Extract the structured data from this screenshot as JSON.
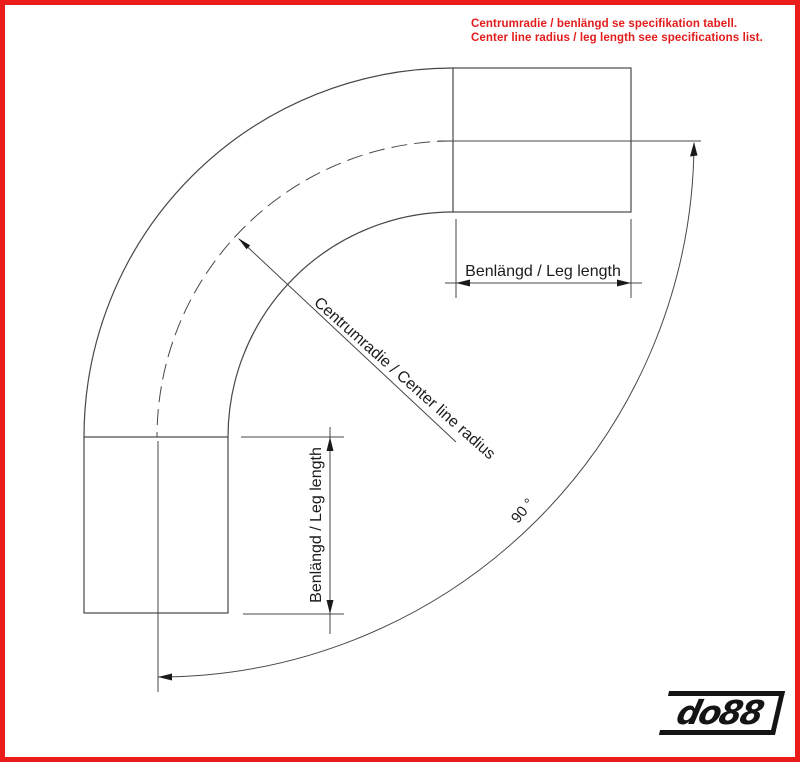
{
  "header": {
    "note_sv": "Centrumradie / benlängd se specifikation tabell.",
    "note_en": "Center line radius / leg length see specifications list."
  },
  "diagram": {
    "type": "technical-drawing",
    "subject": "90 degree pipe elbow with dimension callouts",
    "labels": {
      "top_leg": "Benlängd / Leg length",
      "left_leg": "Benlängd / Leg length",
      "radius": "Centrumradie / Center line radius",
      "angle": "90 °"
    }
  },
  "branding": {
    "logo_text": "do88"
  },
  "colors": {
    "frame_red": "#ea1c1c",
    "note_red": "#e31b1b",
    "line_gray": "#474747",
    "arrow_black": "#1a1a1a",
    "logo_black": "#141414"
  }
}
